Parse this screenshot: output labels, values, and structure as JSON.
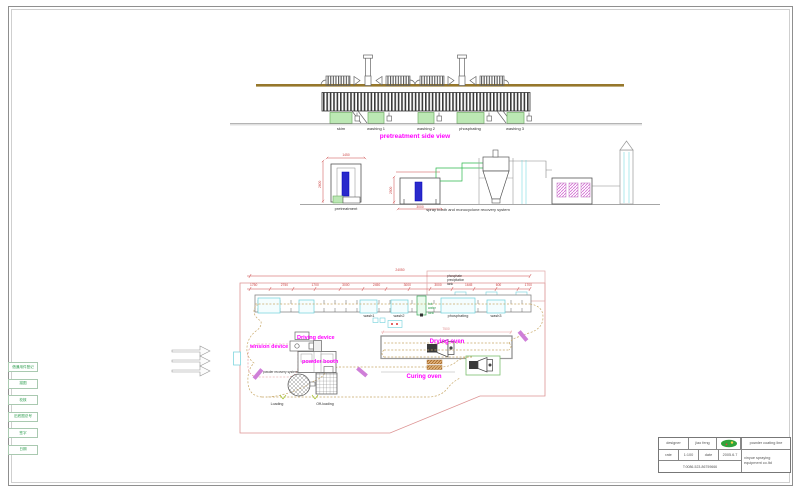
{
  "colors": {
    "magenta": "#ff00ff",
    "dim_red": "#cc4444",
    "room_salmon": "#dd9494",
    "tank_green_fill": "#bce8b4",
    "tank_green_edge": "#6fae63",
    "cyan": "#6ed0da",
    "beam_olive": "#96772b",
    "booth_blue": "#2a2acc",
    "margin_green_text": "#2e9e4f",
    "loop_tan": "#c8a868"
  },
  "side_view": {
    "title": "pretreatment side view",
    "tanks": [
      "skim",
      "washing 1",
      "washing 2",
      "phosphating",
      "washing 3"
    ]
  },
  "section_view": {
    "pretreatment_label": "pretreatment",
    "spray_label": "spray booth and monocyclone recovery system",
    "dims": [
      "2600",
      "1450",
      "2500",
      "3000"
    ]
  },
  "plan_view": {
    "phosphate_tank_lines": [
      "phosphate",
      "precipitation",
      "tank"
    ],
    "hot_water_lines": [
      "hot",
      "water",
      "tank"
    ],
    "tanks": [
      "wash1",
      "wash2",
      "phosphating",
      "wash3"
    ],
    "driving_device": "Driving device",
    "tension_device": "tension device",
    "powder_booth": "powder booth",
    "powder_recovery": "powder recovery system",
    "drying_oven": "Drying oven",
    "curing_oven": "Curing oven",
    "loading": "Loading",
    "offloading": "Off-loading",
    "dims": [
      "1750",
      "2750",
      "1700",
      "3000",
      "2450",
      "3000",
      "3000",
      "1645",
      "600",
      "1700"
    ],
    "overall_dim": "24050",
    "oven_dim": "7500"
  },
  "margin_strip": {
    "rows": [
      "借通用件登记",
      "描图",
      "校核",
      "旧底图总号",
      "签字",
      "日期"
    ]
  },
  "title_block": {
    "designer_label": "designer",
    "designer_value": "jiao feng",
    "rate_label": "rate",
    "rate_value": "1:100",
    "date_label": "date",
    "date_value": "2005.6.7",
    "phone": "T:0086-523-86759666",
    "product": "powder coating line",
    "company_line1": "xinyue spraying",
    "company_line2": "equipment co.ltd"
  }
}
